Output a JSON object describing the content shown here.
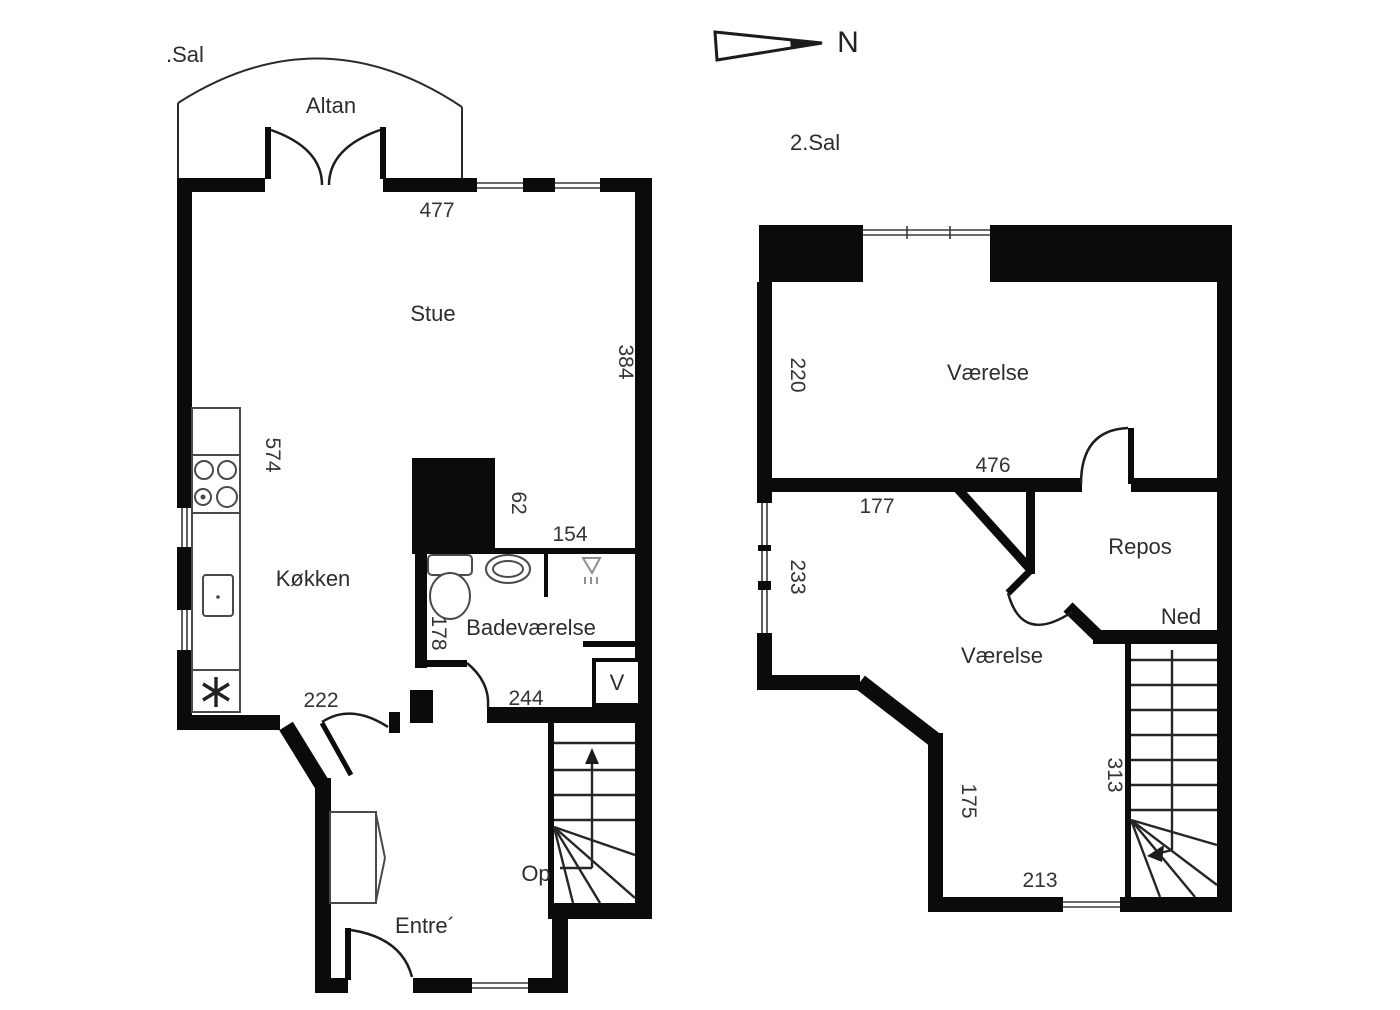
{
  "colors": {
    "wall": "#0b0b0b",
    "thin_line": "#2a2a2a",
    "text": "#2d2d2d",
    "fixture": "#4a4a4a",
    "background": "#ffffff"
  },
  "compass": {
    "north_label": "N"
  },
  "floor1": {
    "title": ".Sal",
    "rooms": {
      "altan": "Altan",
      "stue": "Stue",
      "kokken": "Køkken",
      "badevaerelse": "Badeværelse",
      "entre": "Entre´"
    },
    "stairs_label": "Op",
    "washer_label": "V",
    "dims": {
      "top_width": "477",
      "right_height": "384",
      "kitchen_height": "574",
      "shaft_width": "62",
      "bath_width": "154",
      "bath_height": "178",
      "bath_bottom_width": "244",
      "kitchen_bottom_width": "222"
    }
  },
  "floor2": {
    "title": "2.Sal",
    "rooms": {
      "vaerelse_north": "Værelse",
      "vaerelse_south": "Værelse",
      "repos": "Repos"
    },
    "stairs_label": "Ned",
    "dims": {
      "north_room_height": "220",
      "north_room_width": "476",
      "south_room_width": "177",
      "left_window_height": "233",
      "south_height": "175",
      "stairs_height": "313",
      "bottom_width": "213"
    }
  }
}
